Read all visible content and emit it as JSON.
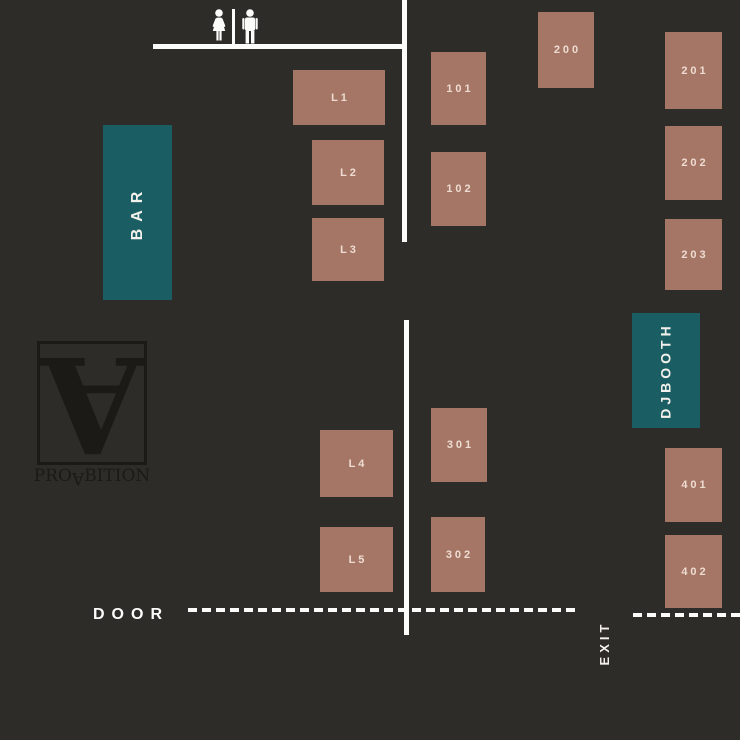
{
  "colors": {
    "bg": "#2e2c28",
    "table": "#a57665",
    "label": "#eedcd2",
    "teal": "#1a5e64",
    "wall": "#fcfcfb",
    "logo": "#1b1a16"
  },
  "legend": {
    "bar_label": "BAR",
    "dj_line1": "DJ",
    "dj_line2": "BOOTH",
    "door_label": "DOOR",
    "exit_label": "EXIT"
  },
  "logo": {
    "monogram": "A",
    "word_pre": "PRO",
    "word_flip": "A",
    "word_post": "BITION"
  },
  "restroom": {
    "icons": [
      "woman-icon",
      "man-icon"
    ]
  },
  "tables": [
    {
      "id": "L1",
      "label": "L1",
      "x": 293,
      "y": 70,
      "w": 92,
      "h": 55
    },
    {
      "id": "L2",
      "label": "L2",
      "x": 312,
      "y": 140,
      "w": 72,
      "h": 65
    },
    {
      "id": "L3",
      "label": "L3",
      "x": 312,
      "y": 218,
      "w": 72,
      "h": 63
    },
    {
      "id": "L4",
      "label": "L4",
      "x": 320,
      "y": 430,
      "w": 73,
      "h": 67
    },
    {
      "id": "L5",
      "label": "L5",
      "x": 320,
      "y": 527,
      "w": 73,
      "h": 65
    },
    {
      "id": "101",
      "label": "101",
      "x": 431,
      "y": 52,
      "w": 55,
      "h": 73
    },
    {
      "id": "102",
      "label": "102",
      "x": 431,
      "y": 152,
      "w": 55,
      "h": 74
    },
    {
      "id": "200",
      "label": "200",
      "x": 538,
      "y": 12,
      "w": 56,
      "h": 76
    },
    {
      "id": "201",
      "label": "201",
      "x": 665,
      "y": 32,
      "w": 57,
      "h": 77
    },
    {
      "id": "202",
      "label": "202",
      "x": 665,
      "y": 126,
      "w": 57,
      "h": 74
    },
    {
      "id": "203",
      "label": "203",
      "x": 665,
      "y": 219,
      "w": 57,
      "h": 71
    },
    {
      "id": "301",
      "label": "301",
      "x": 431,
      "y": 408,
      "w": 56,
      "h": 74
    },
    {
      "id": "302",
      "label": "302",
      "x": 431,
      "y": 517,
      "w": 54,
      "h": 75
    },
    {
      "id": "401",
      "label": "401",
      "x": 665,
      "y": 448,
      "w": 57,
      "h": 74
    },
    {
      "id": "402",
      "label": "402",
      "x": 665,
      "y": 535,
      "w": 57,
      "h": 73
    }
  ]
}
